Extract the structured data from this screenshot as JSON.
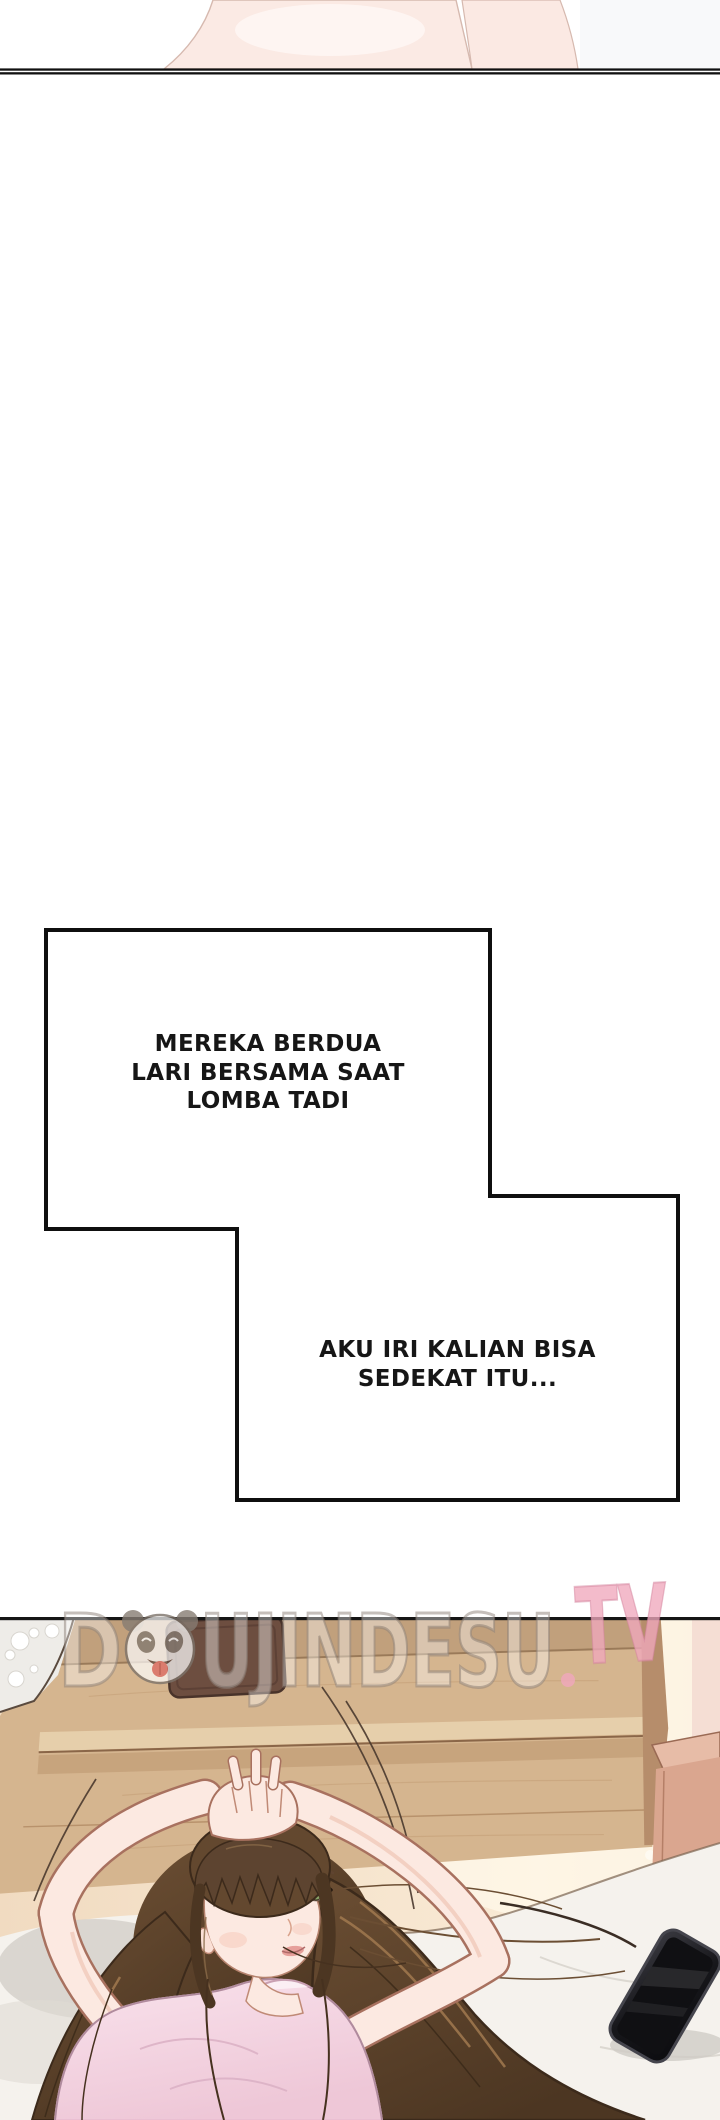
{
  "page": {
    "width": 720,
    "height": 2120,
    "background": "#ffffff"
  },
  "speech_bubbles": [
    {
      "lines": [
        "MEREKA BERDUA",
        "LARI BERSAMA SAAT",
        "LOMBA TADI"
      ]
    },
    {
      "lines": [
        "AKU IRI KALIAN BISA",
        "SEDEKAT ITU..."
      ]
    }
  ],
  "watermark": {
    "prefix": "D",
    "middle": "UJINDESU",
    "suffix": "TV",
    "panda_icon": "panda-face",
    "accent_color": "#f0a8bd",
    "outline_color": "#8d8279"
  },
  "palette": {
    "bubble_fill": "#ffffff",
    "bubble_stroke": "#0f0f0f",
    "panel_border": "#151515",
    "leg_pink": "#fbeae4",
    "wood": "#d5b58f",
    "wood_dark": "#c1a07c",
    "wood_light": "#e6cfab",
    "wood_side": "#b68d6b",
    "wall_warm": "#f5e2c9",
    "wallpaper": "#eeece8",
    "wallpaper_right": "#f4dcd2",
    "object_brown": "#6d4e40",
    "nightstand_top": "#e7bca7",
    "nightstand_front": "#daa68f",
    "bed": "#f5f2ed",
    "bed_shadow": "#d5d1ca",
    "skin": "#fce9e1",
    "skin_line": "#a8715f",
    "hair": "#63482f",
    "hair_dark": "#46311f",
    "hair_light": "#a1794f",
    "shirt": "#f6dbe6",
    "shirt_shade": "#eabfd2",
    "eye_green": "#8aa368",
    "lip": "#e69f9a",
    "phone_body": "#1a1a1e",
    "phone_bezel": "#45454d"
  }
}
